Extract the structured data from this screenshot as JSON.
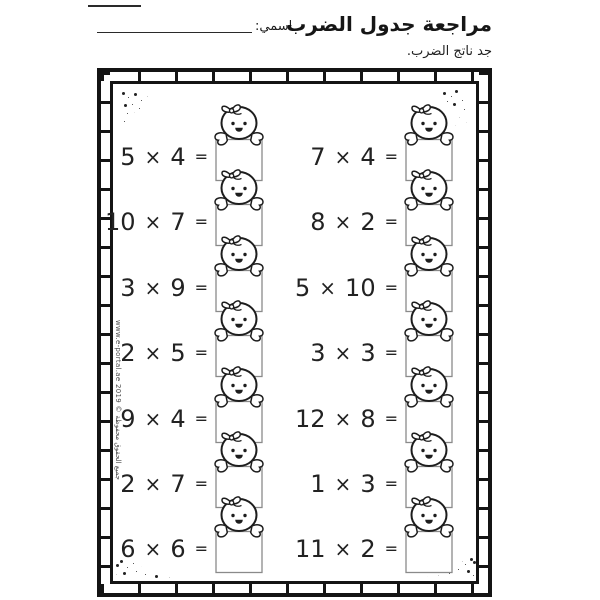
{
  "header": {
    "title": "مراجعة جدول الضرب",
    "subtitle": "جد ناتج الضرب.",
    "name_label": "اسمي:"
  },
  "watermark": "www.e-portal.ae 2019 © جميع الحقوق محفوظة",
  "worksheet": {
    "times_symbol": "×",
    "equals_symbol": "=",
    "answer_value": "",
    "columns": [
      {
        "side": "left",
        "problems": [
          {
            "a": "5",
            "b": "4"
          },
          {
            "a": "10",
            "b": "7"
          },
          {
            "a": "3",
            "b": "9"
          },
          {
            "a": "2",
            "b": "5"
          },
          {
            "a": "9",
            "b": "4"
          },
          {
            "a": "2",
            "b": "7"
          },
          {
            "a": "6",
            "b": "6"
          }
        ]
      },
      {
        "side": "right",
        "problems": [
          {
            "a": "7",
            "b": "4"
          },
          {
            "a": "8",
            "b": "2"
          },
          {
            "a": "5",
            "b": "10"
          },
          {
            "a": "3",
            "b": "3"
          },
          {
            "a": "12",
            "b": "8"
          },
          {
            "a": "1",
            "b": "3"
          },
          {
            "a": "11",
            "b": "2"
          }
        ]
      }
    ]
  },
  "colors": {
    "ink": "#1d1d1d",
    "frame": "#141414",
    "box_border": "#8a8a8a",
    "background": "#ffffff"
  }
}
